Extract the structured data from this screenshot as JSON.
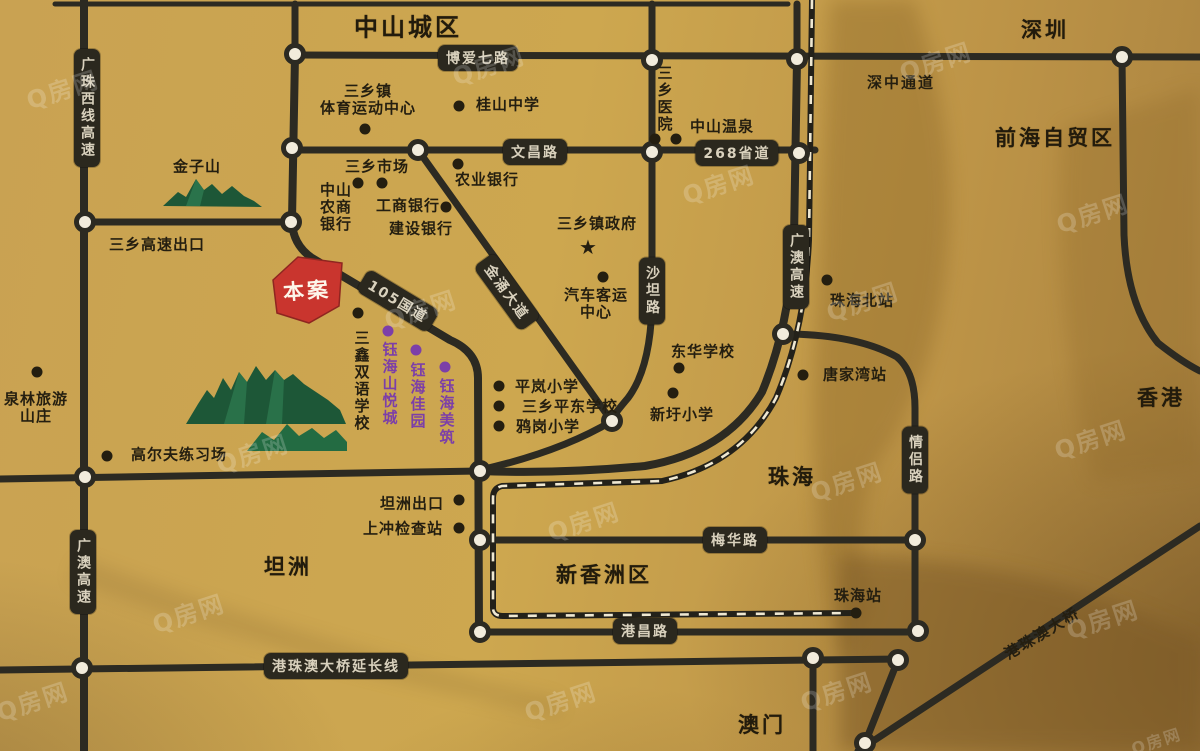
{
  "regions": [
    {
      "text": "中山城区",
      "x": 408,
      "y": 28,
      "size": 24
    },
    {
      "text": "深圳",
      "x": 1045,
      "y": 31,
      "size": 21
    },
    {
      "text": "前海自贸区",
      "x": 1055,
      "y": 139,
      "size": 21
    },
    {
      "text": "香港",
      "x": 1161,
      "y": 399,
      "size": 21
    },
    {
      "text": "珠海",
      "x": 792,
      "y": 478,
      "size": 21
    },
    {
      "text": "坦洲",
      "x": 288,
      "y": 568,
      "size": 21
    },
    {
      "text": "新香洲区",
      "x": 604,
      "y": 576,
      "size": 21
    },
    {
      "text": "澳门",
      "x": 762,
      "y": 726,
      "size": 21
    }
  ],
  "pois": [
    {
      "lines": [
        "三乡镇",
        "体育运动中心"
      ],
      "x": 368,
      "y": 100,
      "dots": [
        [
          365,
          129
        ]
      ]
    },
    {
      "lines": [
        "桂山中学"
      ],
      "x": 508,
      "y": 105,
      "dots": [
        [
          459,
          106
        ]
      ]
    },
    {
      "lines": [
        "三乡市场"
      ],
      "x": 377,
      "y": 167,
      "dots": [
        [
          358,
          183
        ],
        [
          382,
          183
        ]
      ]
    },
    {
      "lines": [
        "中山",
        "农商",
        "银行"
      ],
      "x": 336,
      "y": 207
    },
    {
      "lines": [
        "农业银行"
      ],
      "x": 487,
      "y": 180,
      "dots": [
        [
          458,
          164
        ]
      ]
    },
    {
      "lines": [
        "工商银行"
      ],
      "x": 408,
      "y": 206,
      "dots": [
        [
          446,
          207
        ]
      ]
    },
    {
      "lines": [
        "建设银行"
      ],
      "x": 421,
      "y": 229
    },
    {
      "lines": [
        "三乡医院"
      ],
      "x": 664,
      "y": 99,
      "vertical": true,
      "dots": [
        [
          655,
          139
        ],
        [
          676,
          139
        ]
      ]
    },
    {
      "lines": [
        "中山温泉"
      ],
      "x": 722,
      "y": 127
    },
    {
      "lines": [
        "三乡镇政府"
      ],
      "x": 597,
      "y": 224,
      "star": [
        588,
        247
      ]
    },
    {
      "lines": [
        "汽车客运",
        "中心"
      ],
      "x": 596,
      "y": 304,
      "dots": [
        [
          603,
          277
        ]
      ]
    },
    {
      "lines": [
        "东华学校"
      ],
      "x": 703,
      "y": 352,
      "dots": [
        [
          679,
          368
        ]
      ]
    },
    {
      "lines": [
        "新圩小学"
      ],
      "x": 682,
      "y": 415,
      "dots": [
        [
          673,
          393
        ]
      ]
    },
    {
      "lines": [
        "珠海北站"
      ],
      "x": 862,
      "y": 301,
      "dots": [
        [
          827,
          280
        ]
      ]
    },
    {
      "lines": [
        "唐家湾站"
      ],
      "x": 855,
      "y": 375,
      "dots": [
        [
          803,
          375
        ]
      ]
    },
    {
      "lines": [
        "泉林旅游",
        "山庄"
      ],
      "x": 36,
      "y": 408,
      "dots": [
        [
          37,
          372
        ]
      ]
    },
    {
      "lines": [
        "高尔夫练习场"
      ],
      "x": 179,
      "y": 455,
      "dots": [
        [
          107,
          456
        ]
      ]
    },
    {
      "lines": [
        "三鑫双语学校"
      ],
      "x": 361,
      "y": 381,
      "vertical": true,
      "dots": [
        [
          358,
          313
        ]
      ]
    },
    {
      "lines": [
        "钰海山悦城"
      ],
      "x": 389,
      "y": 384,
      "vertical": true,
      "color": "#7c3fa8",
      "dots": [
        [
          388,
          331
        ]
      ]
    },
    {
      "lines": [
        "钰海佳园"
      ],
      "x": 417,
      "y": 396,
      "vertical": true,
      "color": "#7c3fa8",
      "dots": [
        [
          416,
          350
        ]
      ]
    },
    {
      "lines": [
        "钰海美筑"
      ],
      "x": 446,
      "y": 412,
      "vertical": true,
      "color": "#7c3fa8",
      "dots": [
        [
          445,
          367
        ]
      ]
    },
    {
      "lines": [
        "平岚小学"
      ],
      "x": 547,
      "y": 387,
      "dots": [
        [
          499,
          386
        ]
      ]
    },
    {
      "lines": [
        "三乡平东学校"
      ],
      "x": 570,
      "y": 407,
      "dots": [
        [
          499,
          406
        ]
      ]
    },
    {
      "lines": [
        "鸦岗小学"
      ],
      "x": 548,
      "y": 427,
      "dots": [
        [
          499,
          426
        ]
      ]
    },
    {
      "lines": [
        "坦洲出口"
      ],
      "x": 412,
      "y": 504,
      "dots": [
        [
          459,
          500
        ]
      ]
    },
    {
      "lines": [
        "上冲检查站"
      ],
      "x": 403,
      "y": 529,
      "dots": [
        [
          459,
          528
        ]
      ]
    },
    {
      "lines": [
        "珠海站"
      ],
      "x": 858,
      "y": 596,
      "dots": [
        [
          856,
          613
        ]
      ]
    },
    {
      "lines": [
        "金子山"
      ],
      "x": 197,
      "y": 167
    },
    {
      "lines": [
        "三乡高速出口"
      ],
      "x": 157,
      "y": 245
    }
  ],
  "road_labels": [
    {
      "text": "广珠西线高速",
      "x": 87,
      "y": 108,
      "vertical": true,
      "boxed": true
    },
    {
      "text": "博爱七路",
      "x": 478,
      "y": 58,
      "boxed": true
    },
    {
      "text": "文昌路",
      "x": 535,
      "y": 152,
      "boxed": true
    },
    {
      "text": "268省道",
      "x": 737,
      "y": 153,
      "boxed": true
    },
    {
      "text": "105国道",
      "x": 398,
      "y": 301,
      "rot": 31,
      "boxed": true
    },
    {
      "text": "金涌大道",
      "x": 507,
      "y": 292,
      "rot": 54,
      "boxed": true
    },
    {
      "text": "沙坦路",
      "x": 652,
      "y": 291,
      "vertical": true,
      "boxed": true
    },
    {
      "text": "广澳高速",
      "x": 796,
      "y": 267,
      "vertical": true,
      "boxed": true
    },
    {
      "text": "情侣路",
      "x": 915,
      "y": 460,
      "vertical": true,
      "boxed": true
    },
    {
      "text": "梅华路",
      "x": 735,
      "y": 540,
      "boxed": true
    },
    {
      "text": "港昌路",
      "x": 645,
      "y": 631,
      "boxed": true
    },
    {
      "text": "港珠澳大桥延长线",
      "x": 336,
      "y": 666,
      "boxed": true
    },
    {
      "text": "广澳高速",
      "x": 83,
      "y": 572,
      "vertical": true,
      "boxed": true
    },
    {
      "text": "深中通道",
      "x": 901,
      "y": 82,
      "boxed": false
    },
    {
      "text": "港珠澳大桥",
      "x": 1042,
      "y": 633,
      "rot": -31,
      "boxed": false
    }
  ],
  "landmark": {
    "text": "本案"
  },
  "watermark": {
    "text": "Q房网",
    "positions": [
      [
        62,
        88
      ],
      [
        488,
        64
      ],
      [
        935,
        60
      ],
      [
        718,
        183
      ],
      [
        1092,
        212
      ],
      [
        420,
        308
      ],
      [
        862,
        300
      ],
      [
        1090,
        438
      ],
      [
        252,
        452
      ],
      [
        583,
        520
      ],
      [
        846,
        480
      ],
      [
        188,
        612
      ],
      [
        32,
        700
      ],
      [
        560,
        700
      ],
      [
        836,
        690
      ],
      [
        1102,
        618
      ],
      [
        1156,
        740
      ]
    ]
  },
  "colors": {
    "background_gold": "#c9a252",
    "road_dark": "#2c2a22",
    "label_text": "#d9d1bd",
    "poi_text": "#241e10",
    "project_red": "#c9352e",
    "project_purple": "#7c3fa8",
    "mountain_green": "#1d5737"
  }
}
